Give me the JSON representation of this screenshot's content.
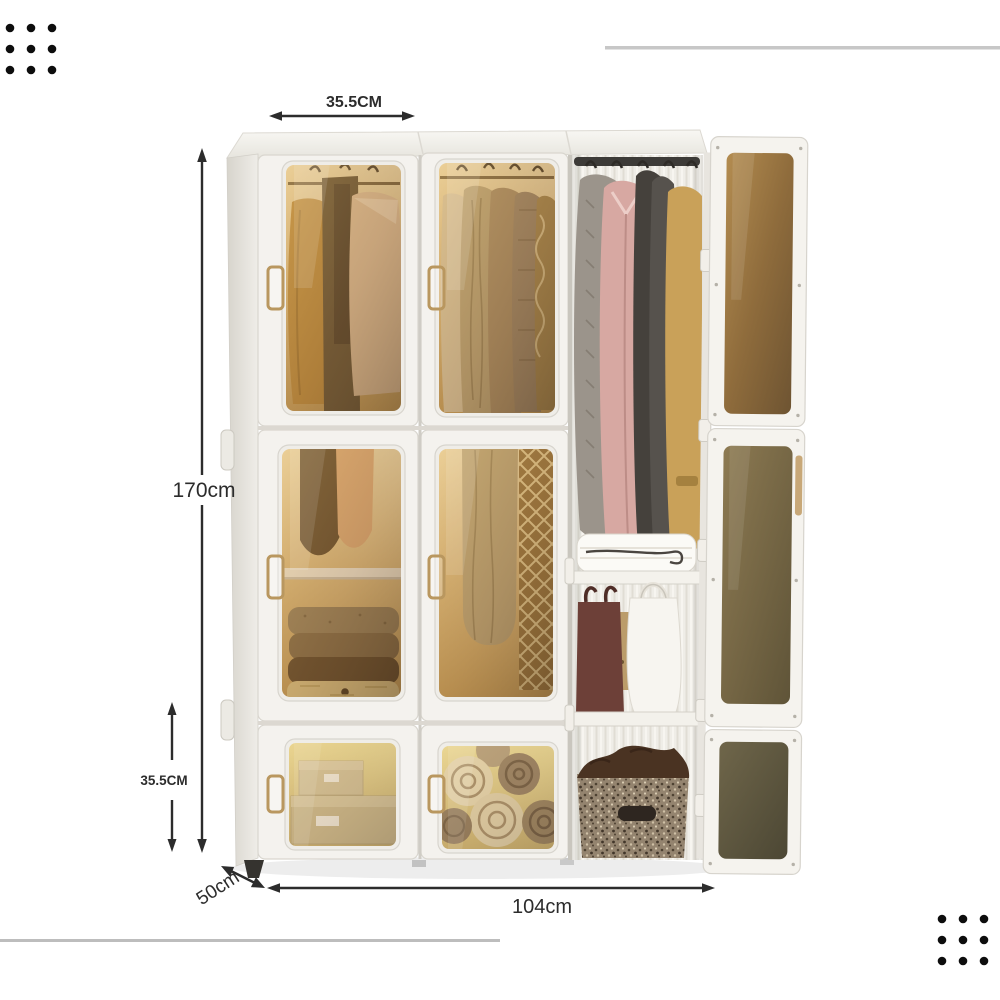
{
  "page": {
    "background": "#ffffff",
    "type": "product-dimension-photo"
  },
  "product": {
    "name": "folding-plastic-wardrobe",
    "dimensions": {
      "top_module_width": "35.5CM",
      "height": "170cm",
      "bottom_module_height": "35.5CM",
      "depth": "50cm",
      "width": "104cm"
    },
    "colors": {
      "frame_white": "#f4f2ee",
      "glass_amber": "#b08a50",
      "glass_olive": "#6f664a",
      "handle_bronze": "#b9975f",
      "annotation_ink": "#2c2c2c",
      "decor_line_gray": "#c7c7c7",
      "decor_dot_black": "#0d0d0d"
    }
  },
  "decorations": {
    "dot_grid_rows": 3,
    "dot_grid_cols": 3,
    "top_right_line": "gray-rule",
    "bottom_left_line": "gray-rule"
  }
}
